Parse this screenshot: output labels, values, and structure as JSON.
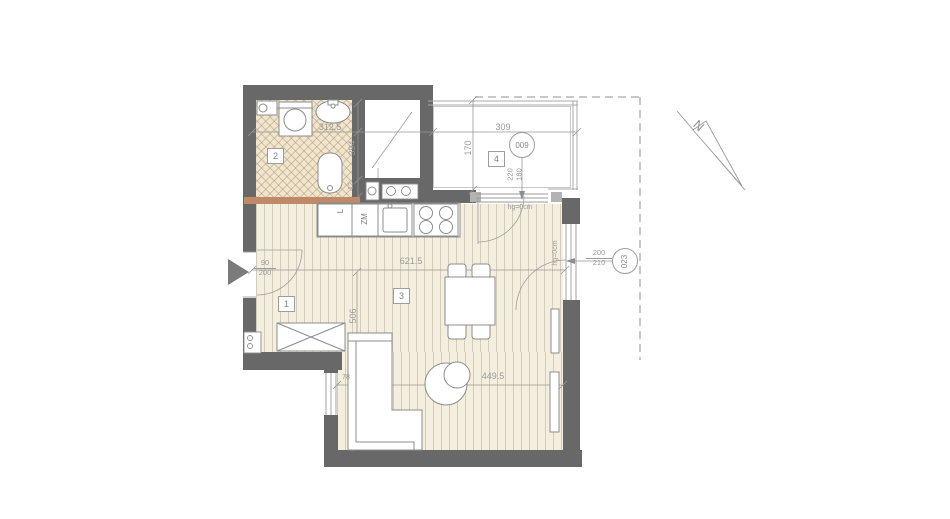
{
  "plan": {
    "rooms": {
      "r1": "1",
      "r2": "2",
      "r3": "3",
      "r4": "4"
    },
    "dims": {
      "bath_width": "312.5",
      "bath_depth": "394",
      "wall_12": "12",
      "balcony_width": "309",
      "balcony_depth": "170",
      "living_width": "621.5",
      "living_width_lower": "449.5",
      "living_depth": "506",
      "window_78": "78"
    },
    "doors": {
      "entry_w": "90",
      "entry_h": "200",
      "terrace_w": "200",
      "terrace_h": "210",
      "balcony_w": "220",
      "balcony_h": "180"
    },
    "tags": {
      "balcony_id": "009",
      "terrace_id": "023"
    },
    "notes": {
      "sill_top": "hg=0cm",
      "sill_right": "hg=0cm"
    },
    "kitchen": {
      "dishwasher": "ZM",
      "fridge": "L"
    },
    "compass": {
      "north": "N"
    },
    "colors": {
      "wall": "#686868",
      "partition": "#c08a68",
      "floor": "#f4eedf",
      "bath_floor": "#f0e5d0",
      "dim_text": "#9a9a9a"
    }
  }
}
